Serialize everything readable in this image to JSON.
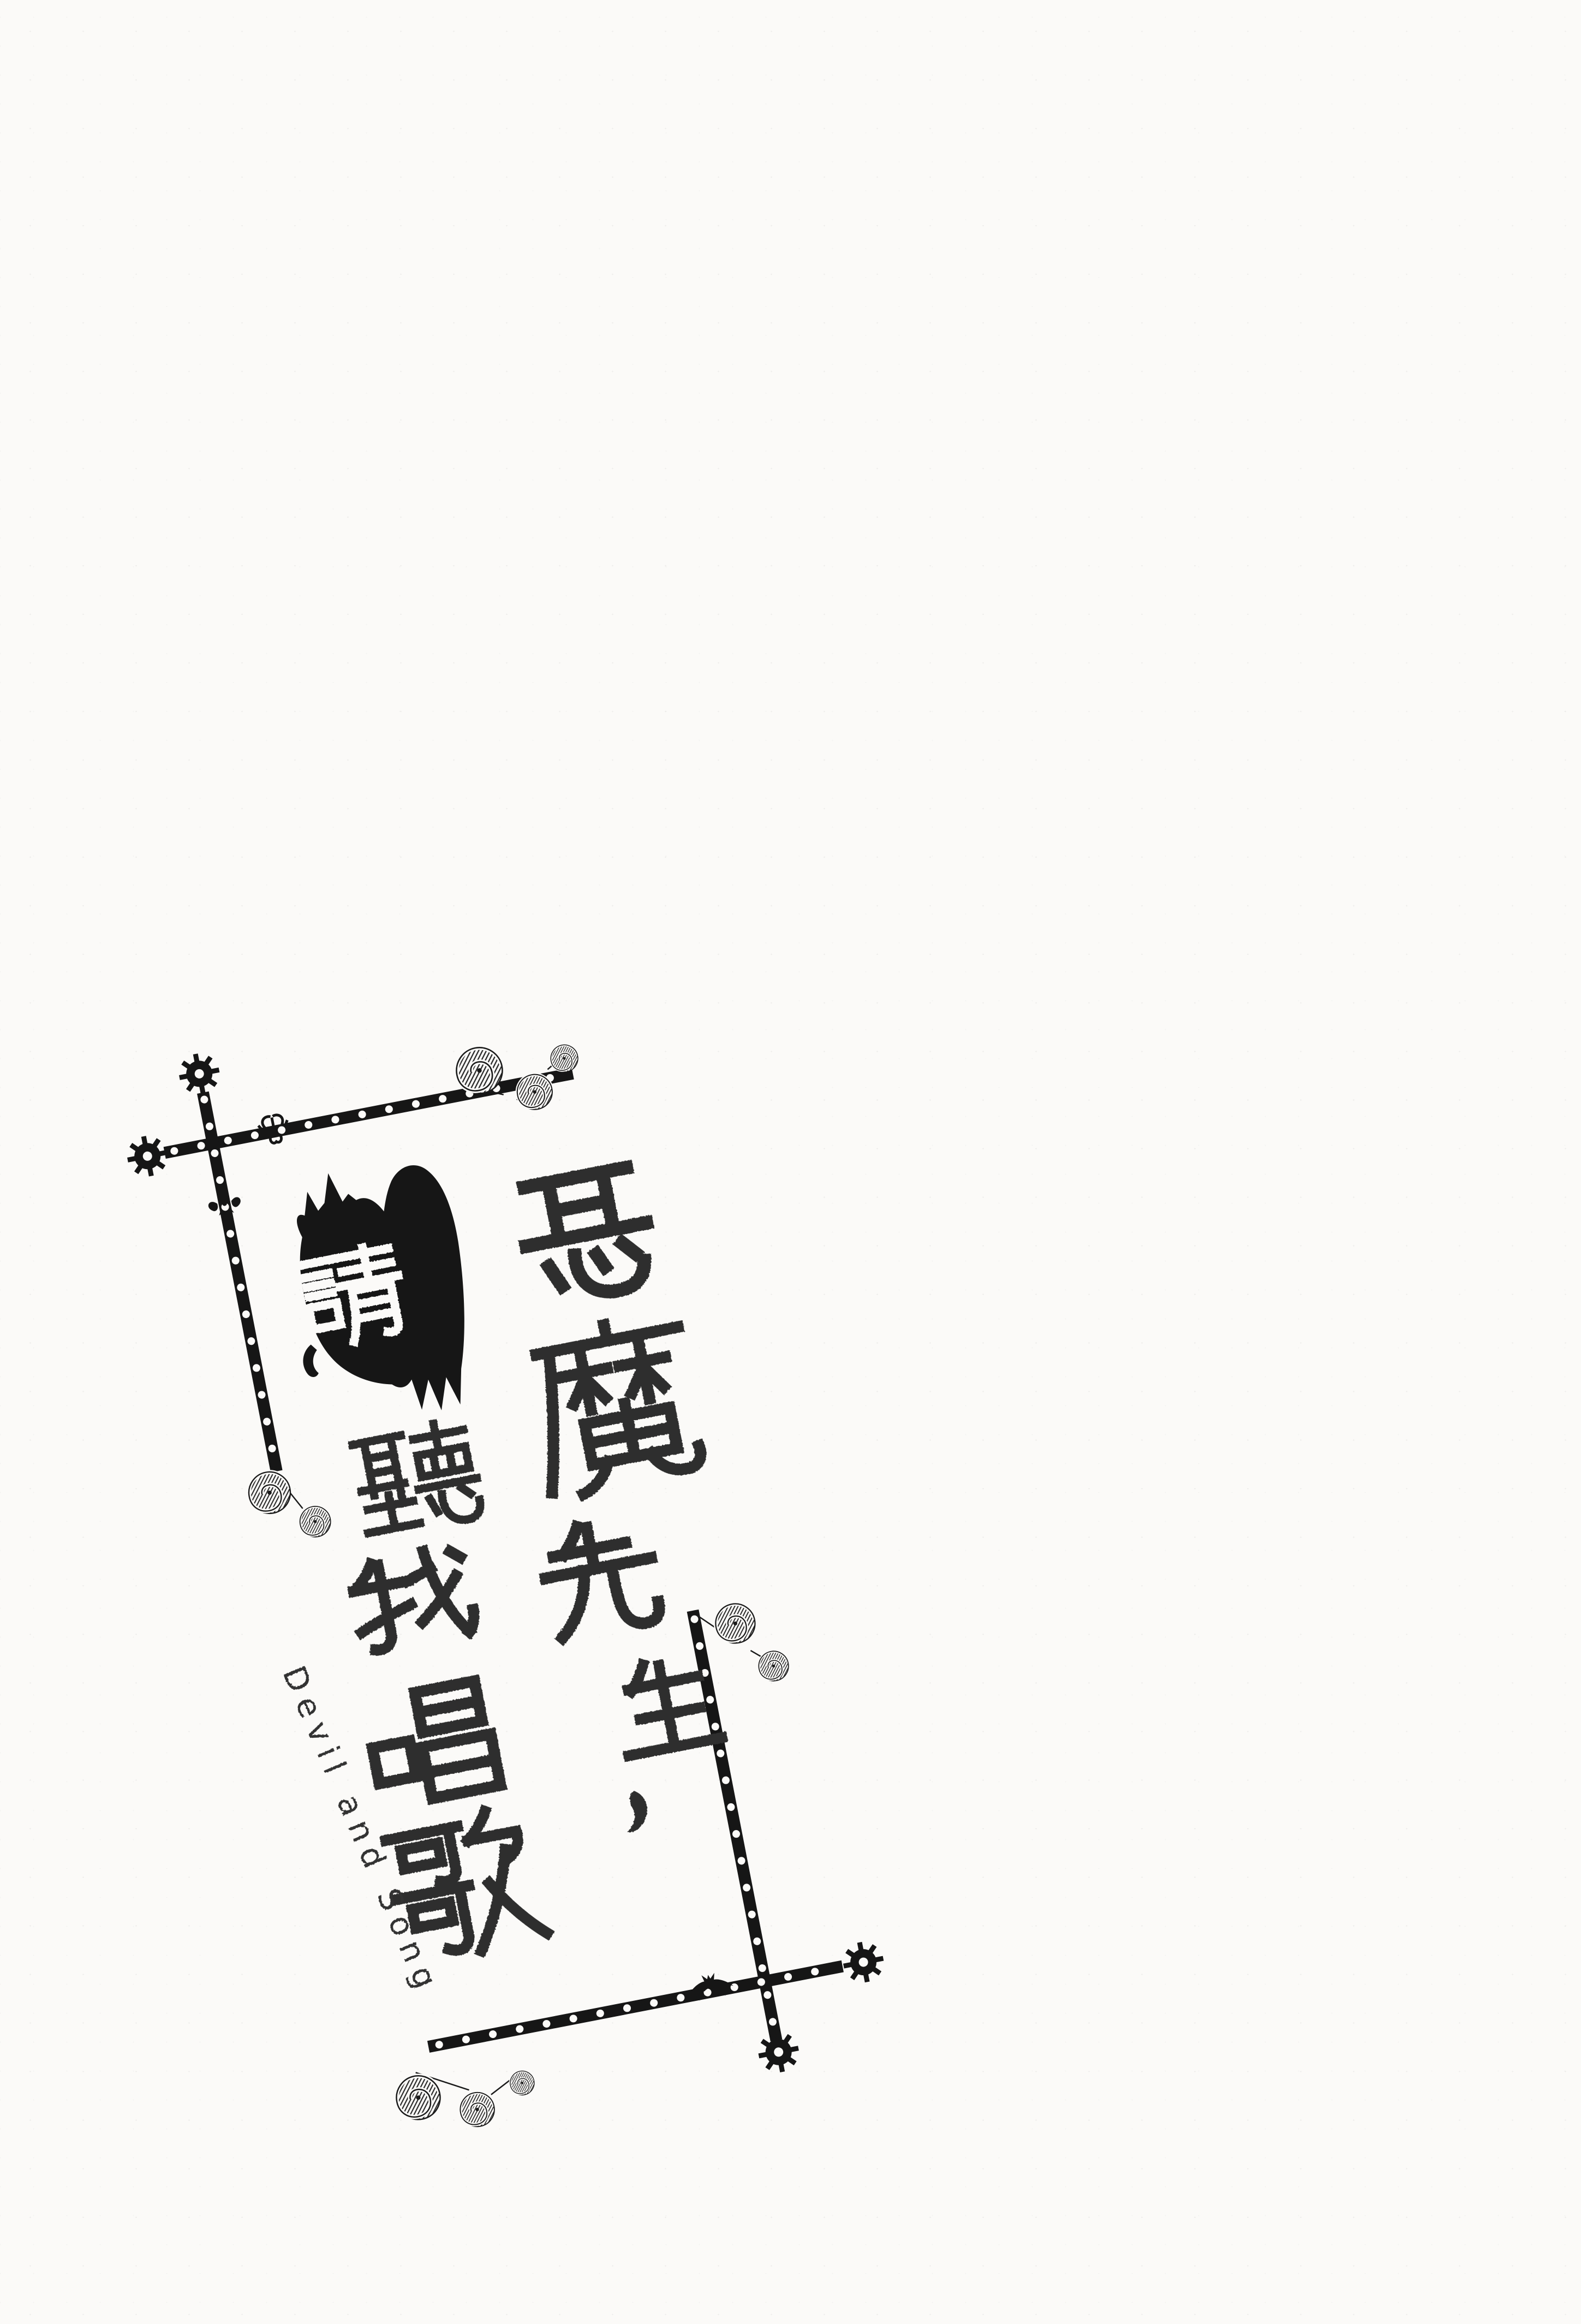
{
  "page": {
    "background": "#fbfaf8",
    "ink": "#161616",
    "type_ink": "#2e2e2e",
    "subtitle_ink": "#303030"
  },
  "artwork": {
    "rotation_deg": -11,
    "title_full": "惡魔先生，請聽我唱歌",
    "subtitle_en": "Devil and Song",
    "columns": {
      "right": [
        "惡",
        "魔",
        "先",
        "生",
        "，"
      ],
      "left": [
        "請",
        "聽",
        "我",
        "唱",
        "歌"
      ]
    },
    "bat_char": "請",
    "ornament_icons": [
      "cross-icon",
      "gear-icon",
      "scroll-icon",
      "bat-icon",
      "devil-wing-icon",
      "fleur-icon",
      "ribbon-icon"
    ]
  }
}
